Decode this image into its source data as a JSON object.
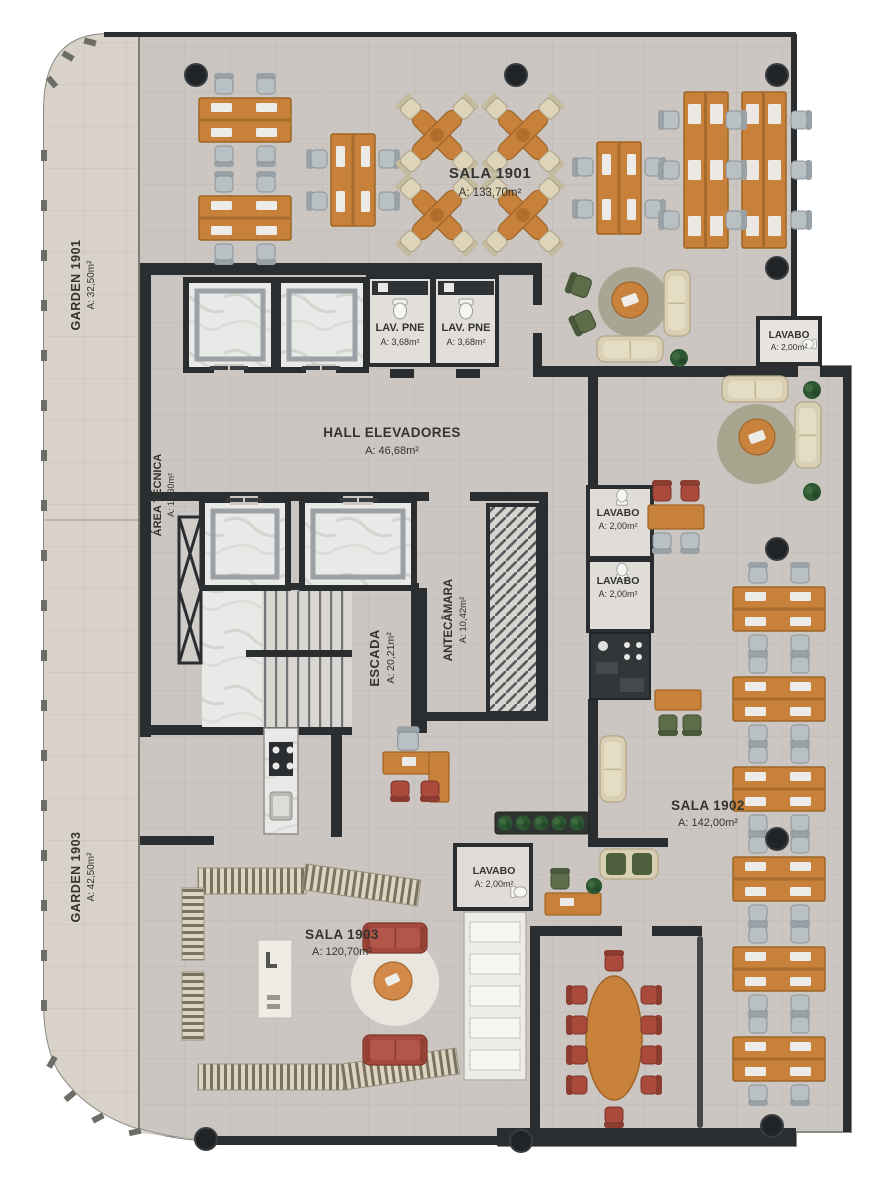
{
  "plan": {
    "title": "Pavimento tipo - planta humanizada",
    "rooms": {
      "sala1901": {
        "name": "SALA 1901",
        "area": "A: 133,70m²"
      },
      "sala1902": {
        "name": "SALA 1902",
        "area": "A: 142,00m²"
      },
      "sala1903": {
        "name": "SALA 1903",
        "area": "A: 120,70m²"
      },
      "garden1901": {
        "name": "GARDEN 1901",
        "area": "A: 32,50m²"
      },
      "garden1903": {
        "name": "GARDEN 1903",
        "area": "A: 42,50m²"
      },
      "hall_elevadores": {
        "name": "HALL ELEVADORES",
        "area": "A: 46,68m²"
      },
      "escada": {
        "name": "ESCADA",
        "area": "A: 20,21m²"
      },
      "antecamara": {
        "name": "ANTECÂMARA",
        "area": "A: 10,42m²"
      },
      "area_tecnica": {
        "name": "ÁREA TÉCNICA",
        "area": "A: 13,30m²"
      },
      "lav_pne_1": {
        "name": "LAV. PNE",
        "area": "A: 3,68m²"
      },
      "lav_pne_2": {
        "name": "LAV. PNE",
        "area": "A: 3,68m²"
      },
      "lavabo_top": {
        "name": "LAVABO",
        "area": "A: 2,00m²"
      },
      "lavabo_mid_1": {
        "name": "LAVABO",
        "area": "A: 2,00m²"
      },
      "lavabo_mid_2": {
        "name": "LAVABO",
        "area": "A: 2,00m²"
      },
      "lavabo_1903": {
        "name": "LAVABO",
        "area": "A: 2,00m²"
      }
    },
    "colors": {
      "wall": "#2b2e31",
      "floor": "#cbc6c1",
      "garden": "#d8d2c8",
      "marble": "#e9e9e7",
      "wood": "#c8813b",
      "chair_gray": "#b9c0c4",
      "chair_beige": "#ded4ba",
      "sofa_beige": "#d9cfb4",
      "red": "#a6493d",
      "green": "#5c6e49",
      "rug": "#a8a592",
      "plant": "#2d5730",
      "label": "#33332f"
    }
  }
}
